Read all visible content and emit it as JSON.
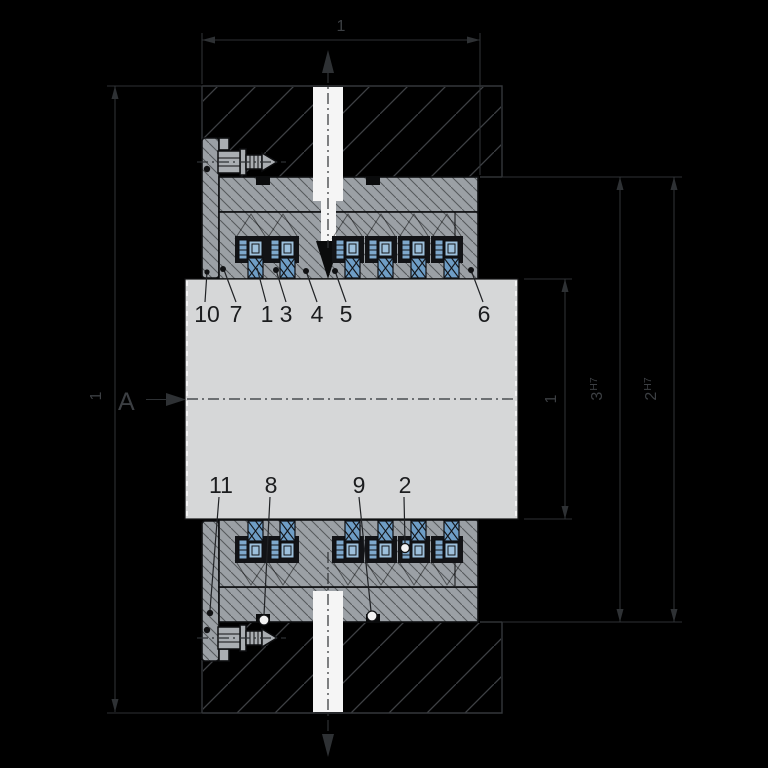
{
  "annotations": {
    "view_label": "A",
    "dim_top_label": "1",
    "dim_left_label": "1",
    "dim_shaft_label": "1",
    "dim_bore_inner": {
      "num": "3",
      "fit": "H7"
    },
    "dim_bore_outer": {
      "num": "2",
      "fit": "H7"
    }
  },
  "callouts": {
    "top": [
      "10",
      "7",
      "1",
      "3",
      "4",
      "5",
      "6"
    ],
    "bottom": [
      "11",
      "8",
      "9",
      "2"
    ]
  },
  "colors": {
    "background": "#000000",
    "annotation_line": "#2e3134",
    "annotation_text": "#3c3f43",
    "housing_hatch": "#3e4145",
    "part_fill": "#9ba0a5",
    "part_fill_light": "#aaaeb2",
    "part_edge": "#0d0e10",
    "shaft_fill": "#d6d7d8",
    "port_fill": "#f5f5f5",
    "seal_blue": "#7ea8cc",
    "seal_blue_light": "#9dc0dc",
    "seal_blue_mid": "#6e9dc5",
    "callout_text": "#1b1c1e"
  }
}
